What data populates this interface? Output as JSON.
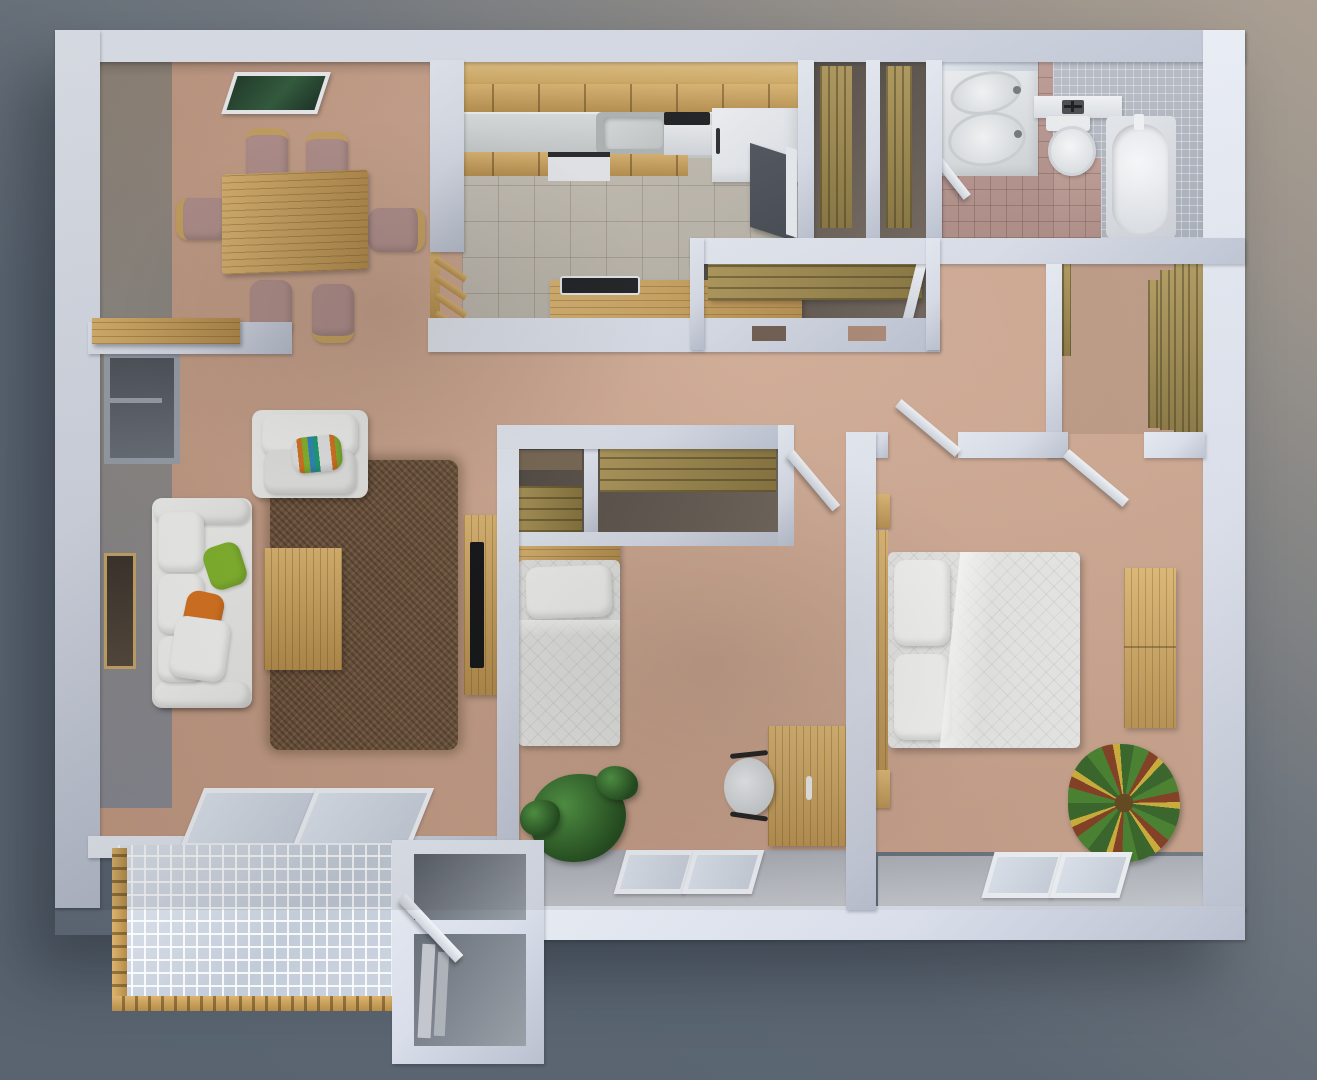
{
  "scene": {
    "type": "3d-floor-plan-render",
    "view": "top-down-isometric",
    "apartment": {
      "rooms": [
        {
          "name": "dining-room",
          "contents": [
            "dining-table",
            "dining-chair-x6",
            "wall-art"
          ]
        },
        {
          "name": "kitchen",
          "contents": [
            "upper-cabinets",
            "counter",
            "sink",
            "stove",
            "refrigerator",
            "dishwasher",
            "peninsula-counter",
            "wood-railing"
          ]
        },
        {
          "name": "entry-hall",
          "contents": [
            "entry-door",
            "linen-closet-x2",
            "hall-closet-with-shelf"
          ]
        },
        {
          "name": "bathroom",
          "contents": [
            "double-vanity",
            "sink-x2",
            "faucet-cross",
            "toilet",
            "bathtub",
            "mosaic-shower-area",
            "door"
          ]
        },
        {
          "name": "walk-in-closet",
          "contents": [
            "stepped-wood-shelving"
          ]
        },
        {
          "name": "living-room",
          "contents": [
            "sofa",
            "armchair",
            "throw-pillows",
            "shag-rug",
            "coffee-table",
            "tv-console",
            "tv",
            "window",
            "wall-niche",
            "wall-shelf",
            "sliding-glass-door"
          ]
        },
        {
          "name": "bedroom-1",
          "contents": [
            "single-bed",
            "closet-shelves",
            "desk",
            "office-chair",
            "plant",
            "window-pair"
          ]
        },
        {
          "name": "bedroom-2",
          "contents": [
            "double-bed",
            "nightstand-x2",
            "dresser",
            "croton-plant",
            "window-pair",
            "door-x2"
          ]
        },
        {
          "name": "balcony",
          "contents": [
            "lattice-railing",
            "storage-room-x2",
            "glass-door"
          ]
        }
      ]
    }
  },
  "palette": {
    "bg_beige": "#ab9f92",
    "bg_slate": "#5b6672",
    "bg_slate2": "#596470",
    "wall": "#d9deea",
    "wall_hi": "#e7ebf3",
    "wall_sh": "#b9c0cf",
    "carpet": "#c49c85",
    "carpet_hi": "#d7b098",
    "carpet_sh": "#a98570",
    "wood_hi": "#dcb46e",
    "wood_dk": "#b58c49",
    "olive_hi": "#ab9455",
    "olive": "#837038",
    "bath_tile_hi": "#bd9a92",
    "bath_tile": "#a8857e",
    "mosaic": "#a2a8b3",
    "gray_floor": "#c2c5cb",
    "dark_int": "#6b6056",
    "fab": "#e6e6e4",
    "fab_hi": "#f4f4f2",
    "rug": "#6d5138",
    "orange": "#d9731f",
    "green": "#83b62c",
    "plant": "#1d4718",
    "croton_r": "#7c3416",
    "croton_y": "#c9a92e",
    "tv": "#101114",
    "glass": "#c7cfdb",
    "glass_hi": "#dde4ee",
    "door_dark": "#3e434b",
    "gray_wallface": "#8b8a8c"
  }
}
